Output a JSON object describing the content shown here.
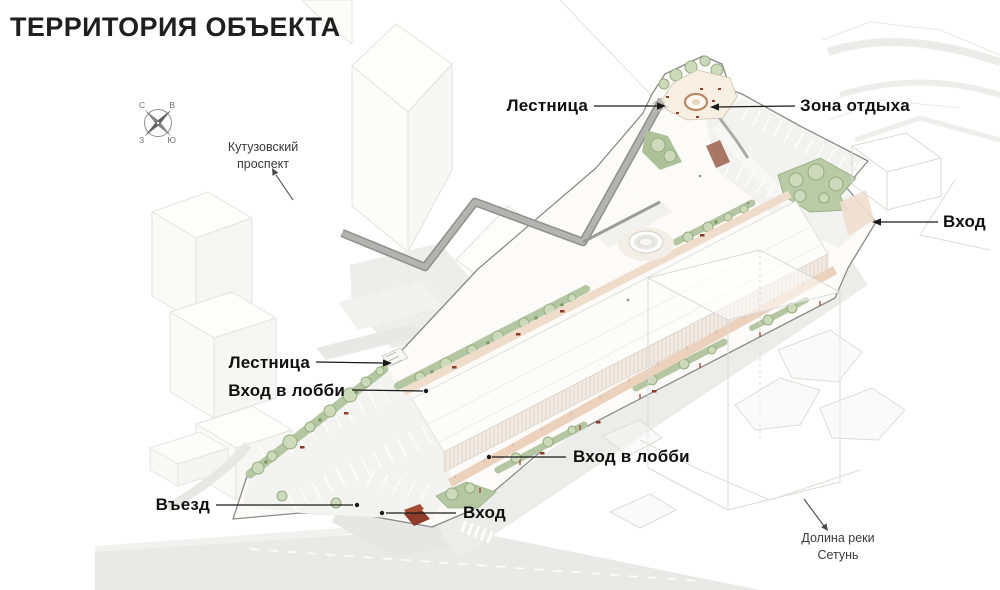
{
  "slide": {
    "title": "ТЕРРИТОРИЯ ОБЪЕКТА"
  },
  "compass": {
    "north": "С",
    "east": "В",
    "west": "З",
    "south": "Ю"
  },
  "context_labels": {
    "kutuzovsky": {
      "line1": "Кутузовский",
      "line2": "проспект"
    },
    "setun": {
      "line1": "Долина реки",
      "line2": "Сетунь"
    }
  },
  "callouts": [
    {
      "id": "stairs-top",
      "label": "Лестница"
    },
    {
      "id": "rest-zone",
      "label": "Зона отдыха"
    },
    {
      "id": "entrance-right",
      "label": "Вход"
    },
    {
      "id": "stairs-left",
      "label": "Лестница"
    },
    {
      "id": "lobby-entrance-left",
      "label": "Вход в лобби"
    },
    {
      "id": "lobby-entrance-bottom",
      "label": "Вход в лобби"
    },
    {
      "id": "driveway",
      "label": "Въезд"
    },
    {
      "id": "entrance-bottom",
      "label": "Вход"
    }
  ],
  "colors": {
    "greenery": "#b5c7a2",
    "tree": "#ccd9ba",
    "walkway_pink": "#ecd2bd",
    "bench_red": "#8e3b28",
    "road_gray": "#e9e9e8",
    "ribbon_gray": "#a9a9a8",
    "leader_line": "#1a1a1a",
    "title_text": "#1f1f1f"
  }
}
